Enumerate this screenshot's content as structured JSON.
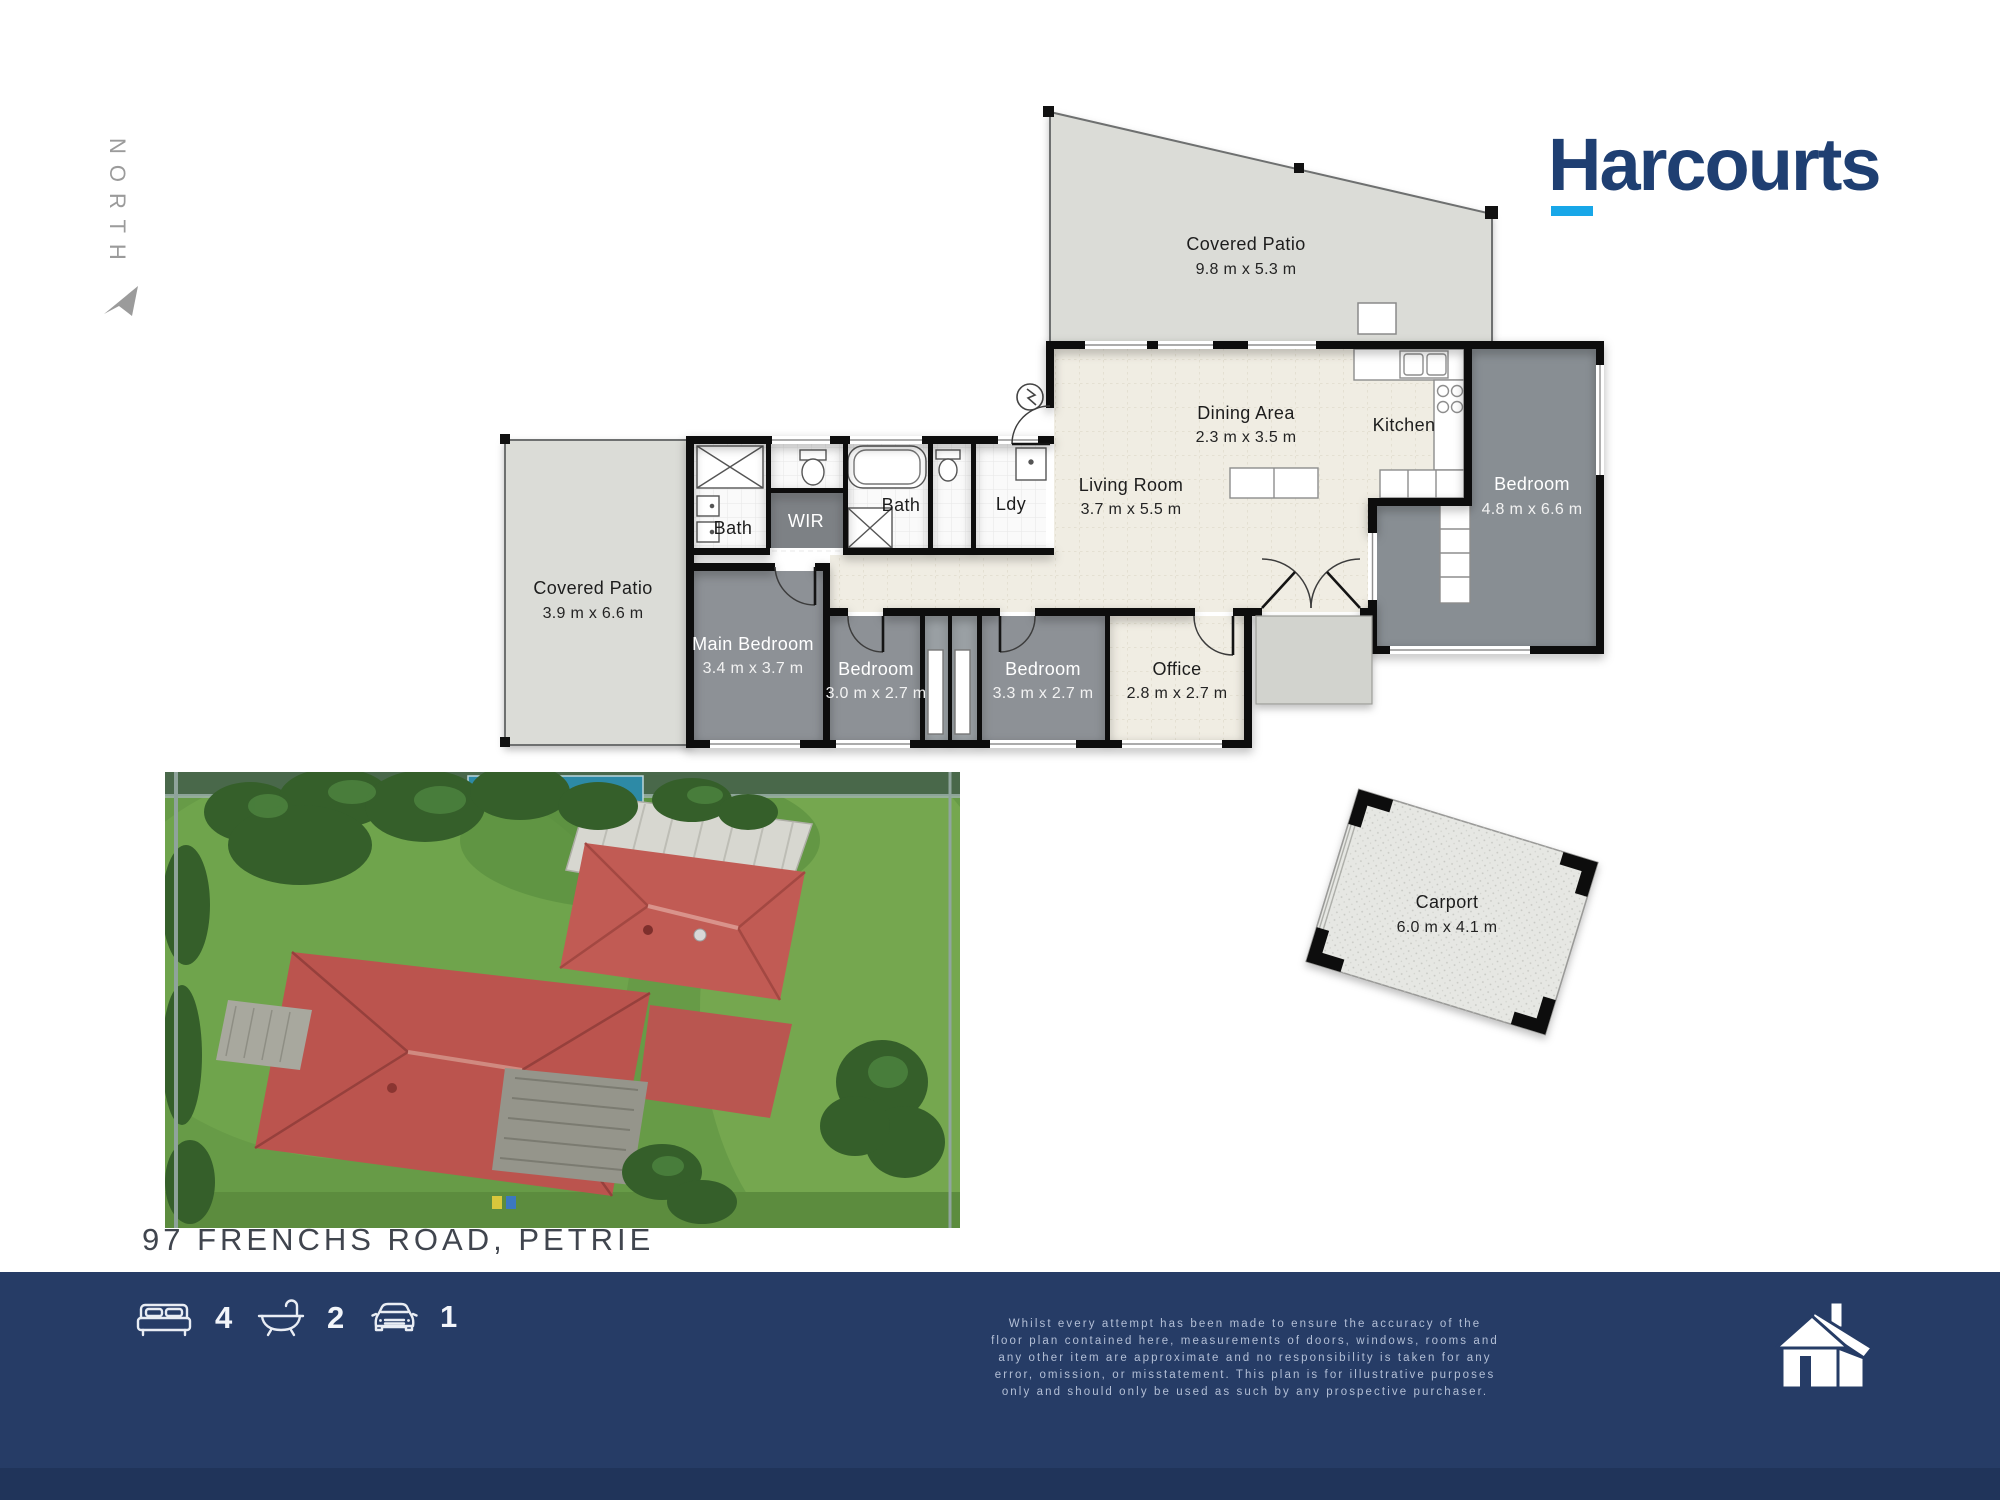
{
  "north": {
    "label": "NORTH"
  },
  "logo": {
    "brand": "Harcourts"
  },
  "address": "97 FRENCHS ROAD, PETRIE",
  "plan": {
    "rooms": {
      "patio_top": {
        "name": "Covered Patio",
        "dims": "9.8 m x 5.3 m"
      },
      "patio_left": {
        "name": "Covered Patio",
        "dims": "3.9 m x 6.6 m"
      },
      "dining": {
        "name": "Dining Area",
        "dims": "2.3 m x 3.5 m"
      },
      "kitchen": {
        "name": "Kitchen"
      },
      "living": {
        "name": "Living Room",
        "dims": "3.7 m x 5.5 m"
      },
      "bath1": {
        "name": "Bath"
      },
      "wir": {
        "name": "WIR"
      },
      "bath2": {
        "name": "Bath"
      },
      "ldy": {
        "name": "Ldy"
      },
      "main_bedroom": {
        "name": "Main Bedroom",
        "dims": "3.4 m x 3.7 m"
      },
      "bedroom2": {
        "name": "Bedroom",
        "dims": "3.0 m x 2.7 m"
      },
      "bedroom3": {
        "name": "Bedroom",
        "dims": "3.3 m x 2.7 m"
      },
      "office": {
        "name": "Office",
        "dims": "2.8 m x 2.7 m"
      },
      "bedroom_right": {
        "name": "Bedroom",
        "dims": "4.8 m x 6.6 m"
      },
      "carport": {
        "name": "Carport",
        "dims": "6.0 m x 4.1 m"
      }
    }
  },
  "footer": {
    "stats": [
      {
        "icon": "bed-icon",
        "value": "4"
      },
      {
        "icon": "bath-icon",
        "value": "2"
      },
      {
        "icon": "car-icon",
        "value": "1"
      }
    ],
    "disclaimer": {
      "lines": [
        "Whilst every attempt has been made to ensure the accuracy of the",
        "floor plan contained here, measurements of doors, windows, rooms and",
        "any other item are approximate and no responsibility is taken for any",
        "error, omission, or misstatement. This plan is for illustrative purposes",
        "only and should only be used as such by any prospective purchaser."
      ]
    }
  },
  "colors": {
    "brand_navy": "#1f3f72",
    "brand_cyan": "#18a7e8",
    "footer_navy": "#263c66",
    "wall_black": "#111111",
    "tile_floor": "#f0ede3",
    "carpet_gray": "#8d9196",
    "patio_gray": "#dbdcd7",
    "roof_red": "#bf5952"
  }
}
